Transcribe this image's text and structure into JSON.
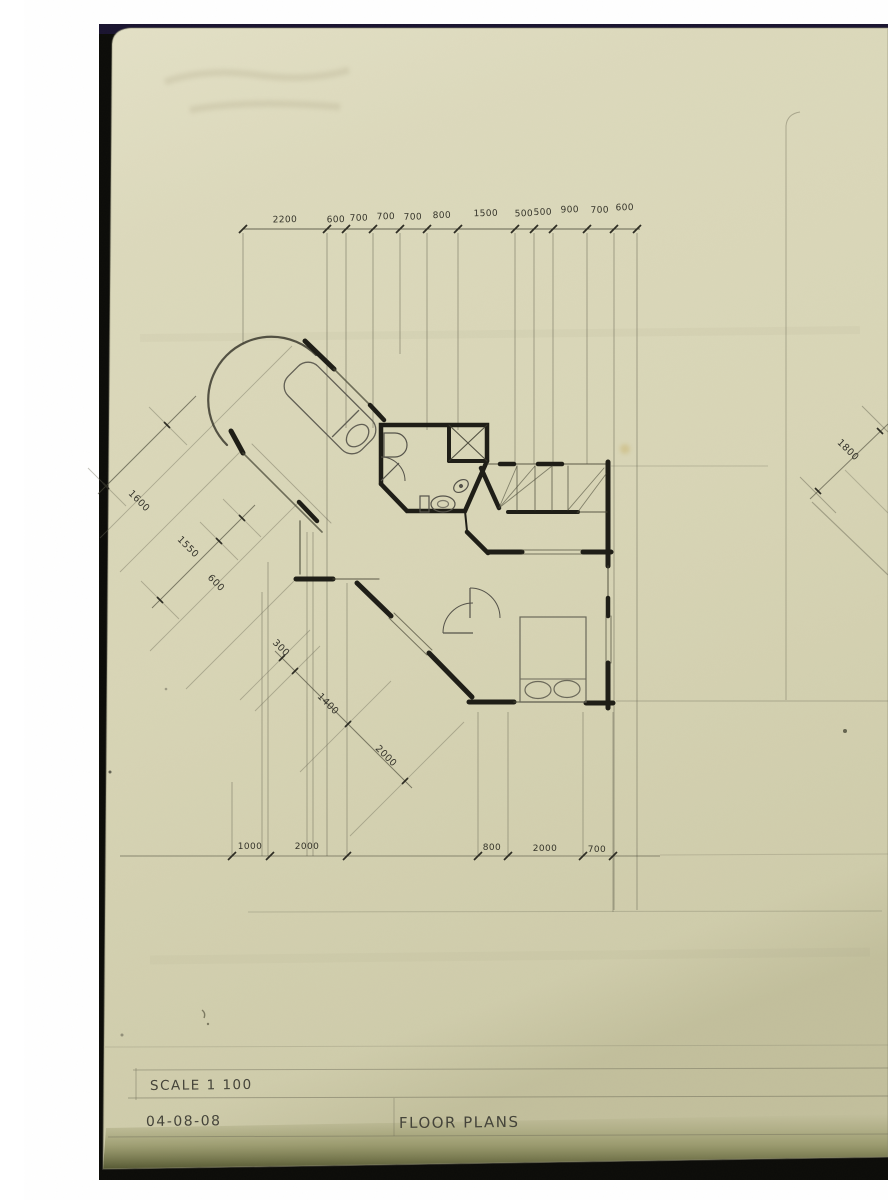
{
  "title_block": {
    "scale_label": "SCALE 1 100",
    "date": "04-08-08",
    "title": "FLOOR PLANS"
  },
  "dimensions": {
    "top_row": [
      "2200",
      "600",
      "700",
      "700",
      "700",
      "800",
      "1500",
      "500",
      "500",
      "900",
      "700",
      "600"
    ],
    "left_diagonal": [
      "1600",
      "1550",
      "600"
    ],
    "lower_diagonal": [
      "300",
      "1400",
      "2000"
    ],
    "bottom_row": [
      "1000",
      "2000",
      "800",
      "2000",
      "700"
    ],
    "right_diagonal": [
      "1800"
    ]
  }
}
